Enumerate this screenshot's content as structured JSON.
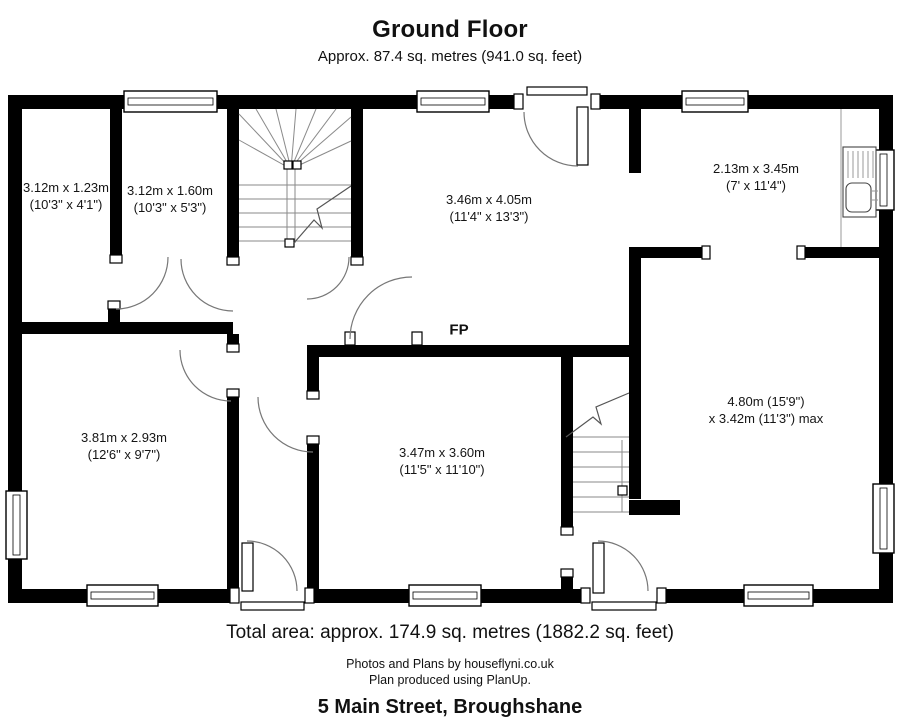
{
  "title": "Ground Floor",
  "subtitle": "Approx. 87.4 sq. metres (941.0 sq. feet)",
  "fireplace_label": "FP",
  "rooms": [
    {
      "id": "room-top-left",
      "label_m": "3.12m x 1.23m",
      "label_ft": "(10'3\" x 4'1\")"
    },
    {
      "id": "room-top-left-2",
      "label_m": "3.12m x 1.60m",
      "label_ft": "(10'3\" x 5'3\")"
    },
    {
      "id": "room-lounge",
      "label_m": "3.46m x 4.05m",
      "label_ft": "(11'4\" x 13'3\")"
    },
    {
      "id": "room-kitchen",
      "label_m": "2.13m x 3.45m",
      "label_ft": "(7' x 11'4\")"
    },
    {
      "id": "room-living",
      "label_m": "4.80m (15'9\")",
      "label_ft": "x 3.42m (11'3\") max"
    },
    {
      "id": "room-bottom-left",
      "label_m": "3.81m x 2.93m",
      "label_ft": "(12'6\" x 9'7\")"
    },
    {
      "id": "room-bottom-mid",
      "label_m": "3.47m x 3.60m",
      "label_ft": "(11'5\" x 11'10\")"
    }
  ],
  "footer": {
    "total_area": "Total area: approx. 174.9 sq. metres (1882.2 sq. feet)",
    "credit_line1": "Photos and Plans by houseflyni.co.uk",
    "credit_line2": "Plan produced using PlanUp.",
    "address": "5 Main Street, Broughshane"
  }
}
